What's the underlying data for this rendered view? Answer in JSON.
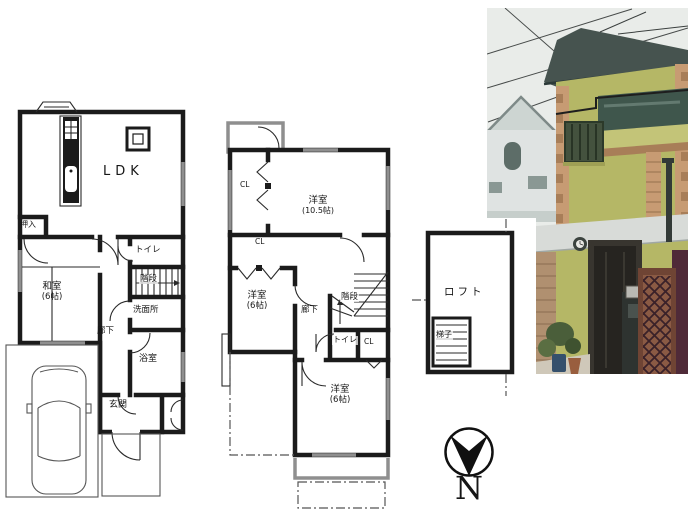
{
  "floor_1f": {
    "labels": {
      "ldk": "LDK",
      "oshiire": "押入",
      "washitsu": [
        "和室",
        "(6帖)"
      ],
      "toilet": "トイレ",
      "stairs": "階段",
      "washroom": "洗面所",
      "hallway": "廊下",
      "bathroom": "浴室",
      "entrance": "玄関"
    }
  },
  "floor_2f": {
    "labels": {
      "closet_top": "CL",
      "closet_mid": "CL",
      "closet_small": "CL",
      "room_large": [
        "洋室",
        "(10.5帖)"
      ],
      "room_mid": [
        "洋室",
        "(6帖)"
      ],
      "room_bottom": [
        "洋室",
        "(6帖)"
      ],
      "hallway": "廊下",
      "stairs": "階段",
      "toilet": "トイレ"
    }
  },
  "loft": {
    "labels": {
      "loft": "ロフト",
      "ladder": "梯子"
    }
  },
  "compass": {
    "north": "N"
  },
  "photo": {
    "colors": {
      "sky": "#e9ece9",
      "wall": "#b5b766",
      "wall_light": "#c3c478",
      "roof": "#46534f",
      "brick": "#c79b73",
      "brick_dark": "#a87e58",
      "balcony_glass": "#3f564c",
      "door": "#262420",
      "fence_dark": "#4f2a38",
      "fence_wood": "#8a5a44",
      "neighbor": "#dfe3e2",
      "stone": "#b09070",
      "foliage": "#4a5e3a",
      "eave": "#d8dbd8"
    }
  }
}
